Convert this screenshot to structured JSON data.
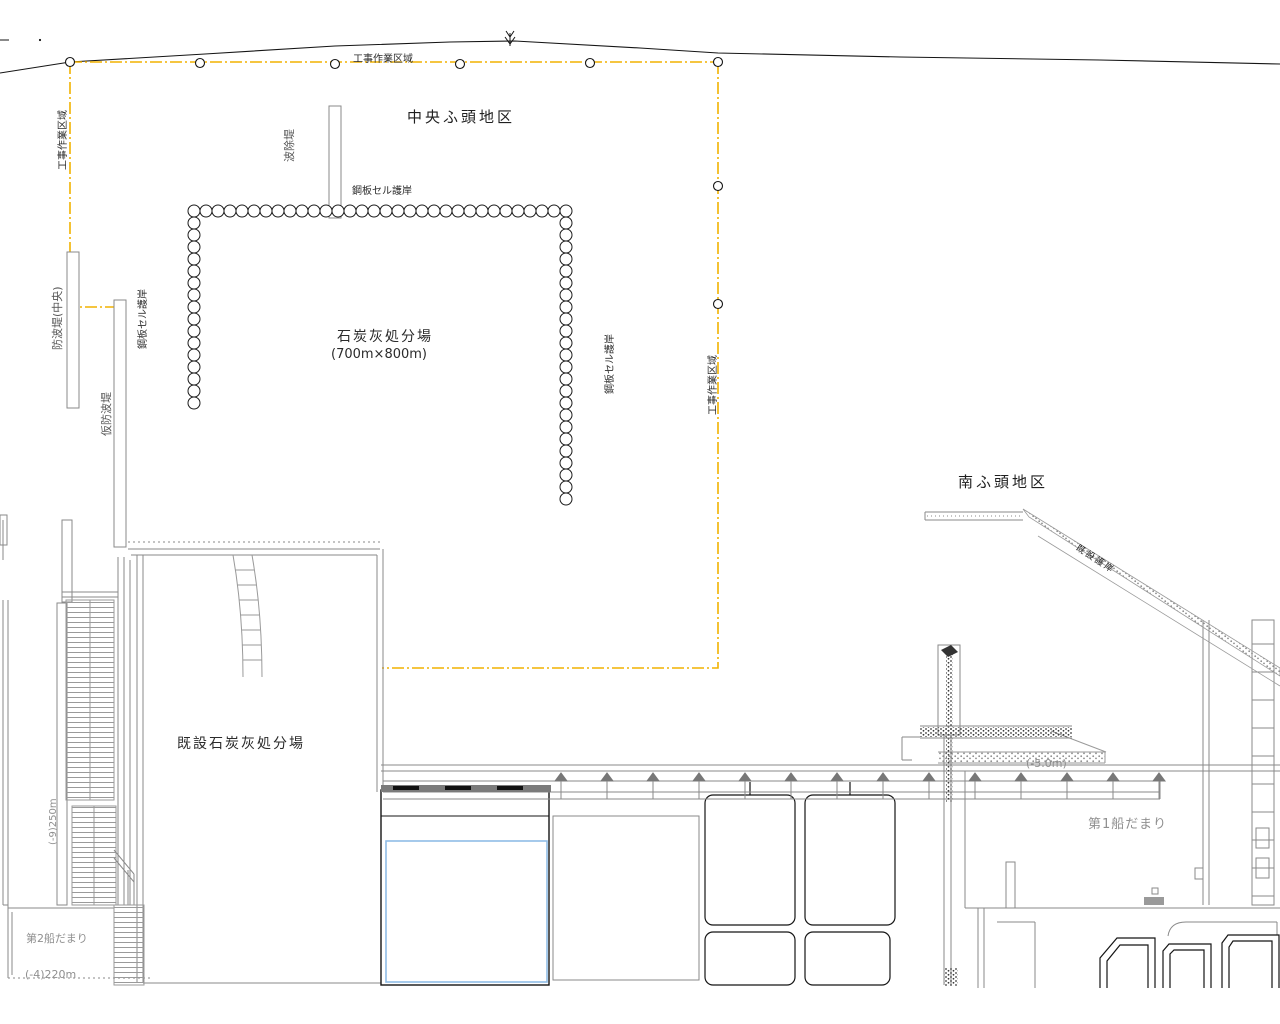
{
  "title": "港湾工事計画平面図",
  "areas": {
    "central_wharf": "中央ふ頭地区",
    "south_wharf": "南ふ頭地区",
    "disposal_site": "石炭灰処分場",
    "disposal_site_size": "(700m×800m)",
    "existing_disposal_site": "既設石炭灰処分場",
    "boat_basin_1": "第1船だまり",
    "boat_basin_2": "第2船だまり"
  },
  "boundary": {
    "work_area_top": "工事作業区域",
    "work_area_left": "工事作業区域",
    "work_area_right": "工事作業区域"
  },
  "structures": {
    "cell_quay_top": "鋼板セル護岸",
    "cell_quay_left": "鋼板セル護岸",
    "cell_quay_right": "鋼板セル護岸",
    "wave_screen": "波除堤",
    "breakwater_central": "防波堤(中央)",
    "temp_breakwater": "仮防波堤",
    "existing_revetment": "既設護岸"
  },
  "depths": {
    "basin1_depth": "(-5.0m)",
    "berth_left_spec": "(-9)250m",
    "basin2_spec": "(-4)220m"
  },
  "colors": {
    "work_area_boundary": "#F2B200",
    "pond_outline_blue": "#8FBCE6",
    "linework_gray": "#8a8a8a",
    "linework_dark": "#151515"
  }
}
